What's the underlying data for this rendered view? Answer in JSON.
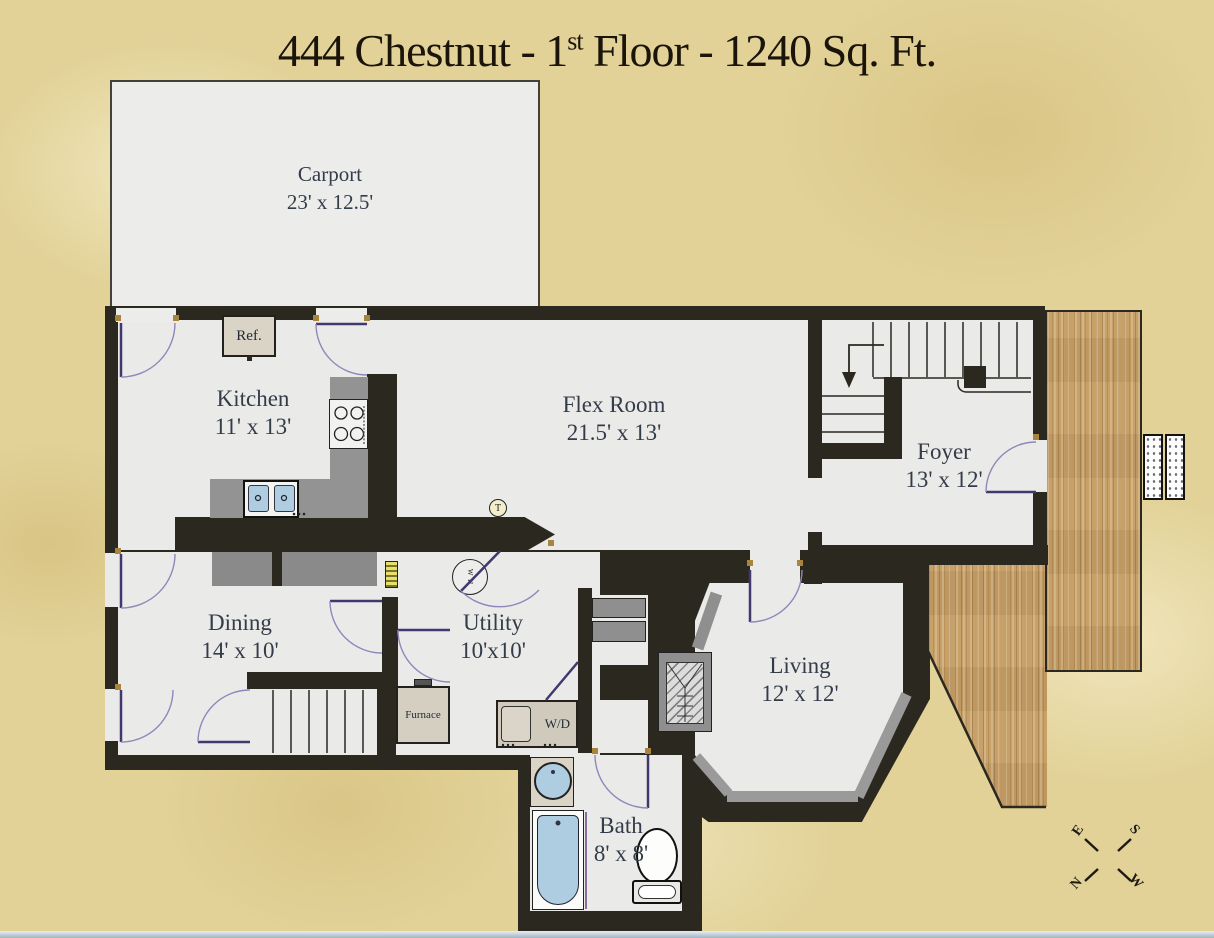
{
  "title": {
    "prefix": "444 Chestnut - 1",
    "sup": "st",
    "suffix": " Floor - 1240 Sq. Ft."
  },
  "rooms": [
    {
      "name": "Carport",
      "dims": "23' x 12.5'"
    },
    {
      "name": "Kitchen",
      "dims": "11' x 13'"
    },
    {
      "name": "Flex Room",
      "dims": "21.5' x 13'"
    },
    {
      "name": "Foyer",
      "dims": "13' x 12'"
    },
    {
      "name": "Dining",
      "dims": "14' x 10'"
    },
    {
      "name": "Utility",
      "dims": "10'x10'"
    },
    {
      "name": "Living",
      "dims": "12' x 12'"
    },
    {
      "name": "Bath",
      "dims": "8' x 8'"
    }
  ],
  "fixtures": {
    "refrigerator": "Ref.",
    "furnace": "Furnace",
    "washer_dryer": "W/D",
    "water_heater": "W H",
    "thermostat": "T"
  },
  "compass": {
    "east": "E",
    "south": "S",
    "north": "N",
    "west": "W"
  },
  "colors": {
    "background": "#e2d298",
    "walls": "#2b2820",
    "floor": "#eaeae8",
    "wood_deck": "#c7a168",
    "counter_gray": "#939393",
    "fixture_blue": "#aecde0",
    "door_accent": "#9186bb",
    "title_text": "#1a140a",
    "label_text": "#343b49"
  }
}
